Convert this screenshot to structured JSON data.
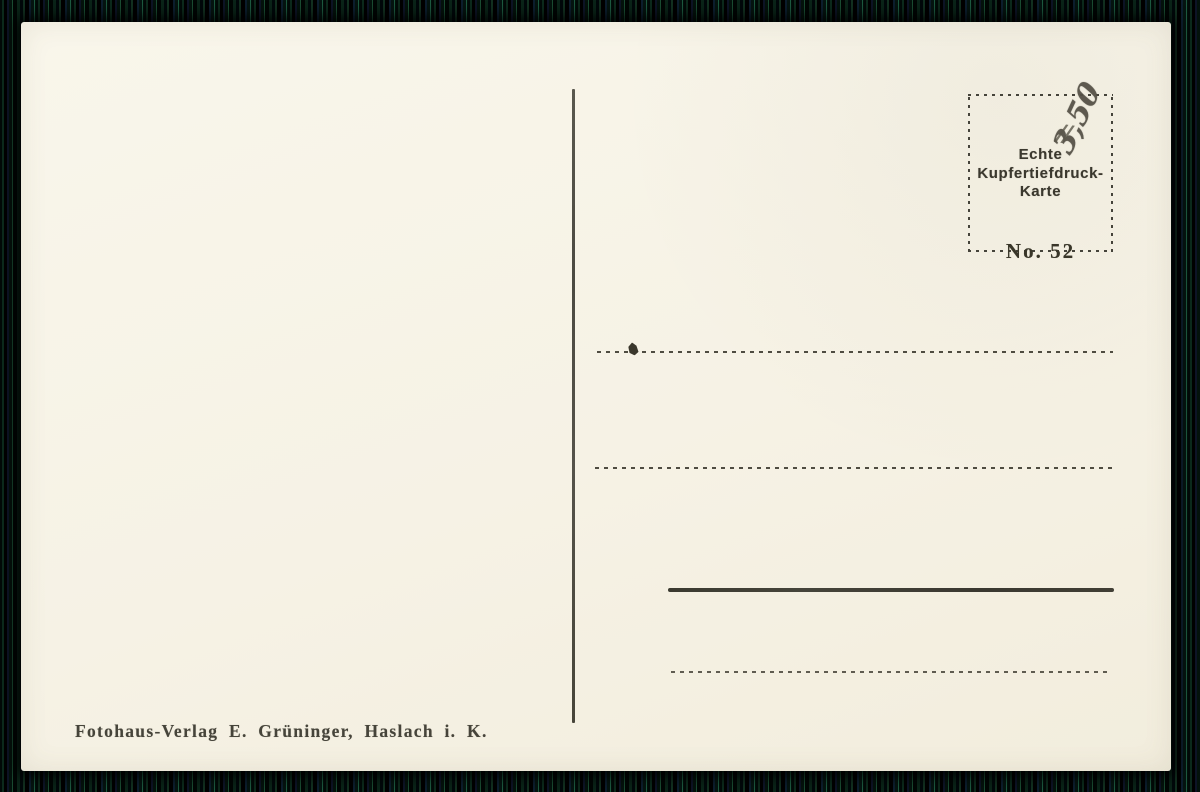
{
  "scan": {
    "card_background": "#f6f2e5",
    "edge_stripe_colors": [
      "#020a08",
      "#0c2a1c",
      "#000000",
      "#0d1426",
      "#1a4c32",
      "#0c1e2e",
      "#1d5a40"
    ],
    "ink_color": "#3b382e",
    "pencil_color": "#545045"
  },
  "stamp_box": {
    "line1": "Echte",
    "line2": "Kupfertiefdruck-",
    "line3": "Karte",
    "number": "No. 52"
  },
  "handwriting": {
    "price": "3,50",
    "slashes": "//"
  },
  "imprint": {
    "publisher": "Fotohaus-Verlag E. Grüninger, Haslach i. K."
  }
}
